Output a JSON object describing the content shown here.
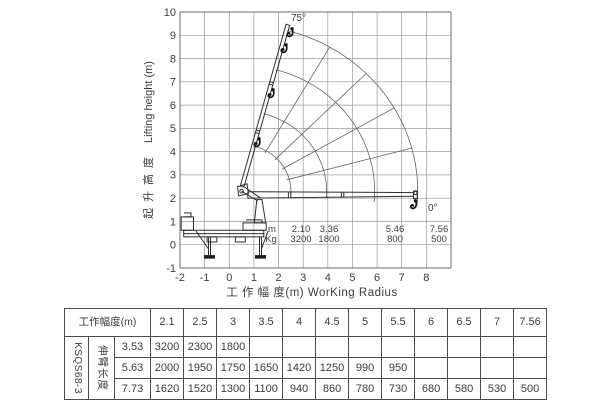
{
  "chart": {
    "y_axis_label_cn": "起升高度",
    "y_axis_label_en": "Lifting height (m)",
    "x_axis_label": "工 作 幅 度(m) WorKing Radius",
    "x_ticks": [
      "-2",
      "-1",
      "0",
      "1",
      "2",
      "3",
      "4",
      "5",
      "6",
      "7",
      "8"
    ],
    "y_ticks": [
      "10",
      "9",
      "8",
      "7",
      "6",
      "5",
      "4",
      "3",
      "2",
      "1",
      "0",
      "-1"
    ],
    "max_angle_label": "75°",
    "min_angle_label": "0°",
    "inline_table": {
      "row_label_m": "m",
      "row_label_kg": "Kg",
      "radii": [
        "2.10",
        "3.36",
        "5.46",
        "7.56"
      ],
      "loads": [
        "3200",
        "1800",
        "800",
        "500"
      ]
    }
  },
  "chart_data": {
    "type": "line",
    "title": "Truck-mounted knuckle boom crane working range and load chart",
    "xlabel": "工作幅度(m) WorKing Radius",
    "ylabel": "起升高度 Lifting height (m)",
    "xlim": [
      -2,
      9
    ],
    "ylim": [
      -1,
      10
    ],
    "grid": true,
    "boom_angle_range_deg": [
      0,
      75
    ],
    "max_reach_points": {
      "radius_m": [
        2.1,
        3.36,
        5.46,
        7.56
      ],
      "load_kg": [
        3200,
        1800,
        800,
        500
      ]
    },
    "series": [
      {
        "name": "伸臂长度 3.53 m",
        "x": [
          2.1,
          2.5,
          3
        ],
        "values": [
          3200,
          2300,
          1800
        ]
      },
      {
        "name": "伸臂长度 5.63 m",
        "x": [
          2.1,
          2.5,
          3,
          3.5,
          4,
          4.5,
          5,
          5.5
        ],
        "values": [
          2000,
          1950,
          1750,
          1650,
          1420,
          1250,
          990,
          950
        ]
      },
      {
        "name": "伸臂长度 7.73 m",
        "x": [
          2.1,
          2.5,
          3,
          3.5,
          4,
          4.5,
          5,
          5.5,
          6,
          6.5,
          7,
          7.56
        ],
        "values": [
          1620,
          1520,
          1300,
          1100,
          940,
          860,
          780,
          730,
          680,
          580,
          530,
          500
        ]
      }
    ]
  },
  "load_table": {
    "header_label": "工作幅度(m)",
    "columns": [
      "2.1",
      "2.5",
      "3",
      "3.5",
      "4",
      "4.5",
      "5",
      "5.5",
      "6",
      "6.5",
      "7",
      "7.56"
    ],
    "model": "KSQS68-3",
    "row_group_label": "伸臂长度",
    "rows": [
      {
        "boom_length": "3.53",
        "values": [
          "3200",
          "2300",
          "1800",
          "",
          "",
          "",
          "",
          "",
          "",
          "",
          "",
          ""
        ]
      },
      {
        "boom_length": "5.63",
        "values": [
          "2000",
          "1950",
          "1750",
          "1650",
          "1420",
          "1250",
          "990",
          "950",
          "",
          "",
          "",
          ""
        ]
      },
      {
        "boom_length": "7.73",
        "values": [
          "1620",
          "1520",
          "1300",
          "1100",
          "940",
          "860",
          "780",
          "730",
          "680",
          "580",
          "530",
          "500"
        ]
      }
    ]
  }
}
